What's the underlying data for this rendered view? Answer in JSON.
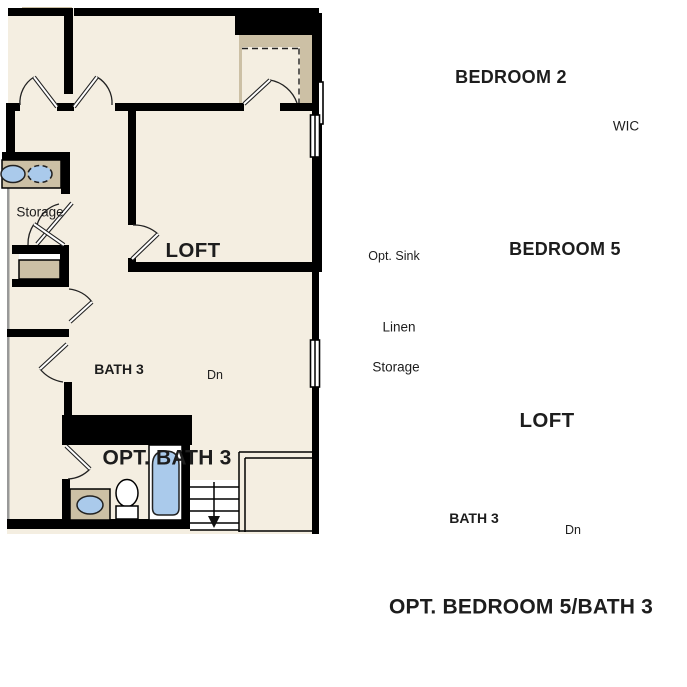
{
  "colors": {
    "background": "#ffffff",
    "floor": "#f4eee1",
    "wall": "#000000",
    "counter": "#ccc0a5",
    "fixture_blue": "#aacaeb",
    "text": "#1d1d1d"
  },
  "plans": [
    {
      "id": "opt-bath-3",
      "caption": "OPT. BATH 3",
      "labels": {
        "storage": "Storage",
        "loft": "LOFT",
        "bath": "BATH 3",
        "dn": "Dn"
      }
    },
    {
      "id": "opt-bedroom-5-bath-3",
      "caption": "OPT. BEDROOM 5/BATH 3",
      "labels": {
        "bedroom2": "BEDROOM 2",
        "wic": "WIC",
        "bedroom5": "BEDROOM 5",
        "opt_sink": "Opt. Sink",
        "linen": "Linen",
        "storage": "Storage",
        "loft": "LOFT",
        "bath": "BATH 3",
        "dn": "Dn"
      }
    }
  ]
}
